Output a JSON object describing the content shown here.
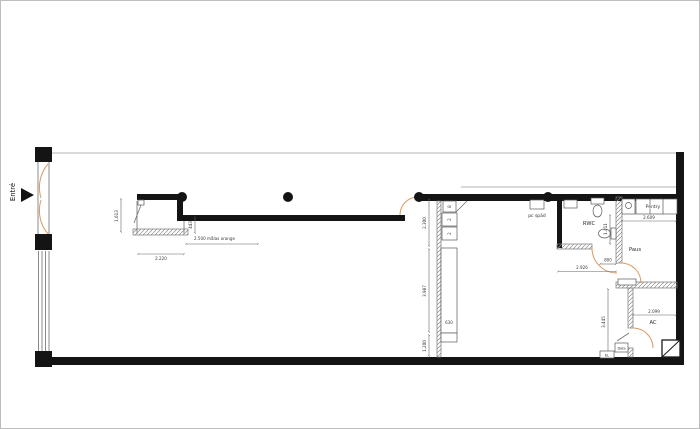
{
  "app": {
    "background": "#ffffff",
    "frame_border": "#bdbdbd"
  },
  "plan": {
    "entrance": {
      "label": "Entré"
    },
    "rooms": {
      "rwc": "RWC",
      "paus": "Paus",
      "ac": "AC",
      "pentry": "Pentry",
      "pc_spad": "pc späd"
    },
    "small_labels": {
      "data": "Data",
      "el": "EL"
    },
    "fixtures": {
      "box_top": "8",
      "box_mid": "2",
      "box_bot": "2",
      "counter_depth": "630"
    },
    "dimensions": {
      "entry_width": "1.613",
      "room_width": "2.220",
      "wall_offset": "443",
      "orange_note": "2.500 målas orange",
      "kitchen_top": "2.300",
      "kitchen_mid": "3.987",
      "kitchen_bot": "1.200",
      "rwc_side": "1.411",
      "rwc_door": "800",
      "corridor": "2.926",
      "pentry_width": "2.609",
      "ac_width": "2.099",
      "right_corridor": "3.445"
    },
    "colors": {
      "wall": "#141414",
      "door_arc": "#d89a62",
      "hatch_line": "#8c8c8c",
      "dimension_line": "#666666"
    }
  }
}
